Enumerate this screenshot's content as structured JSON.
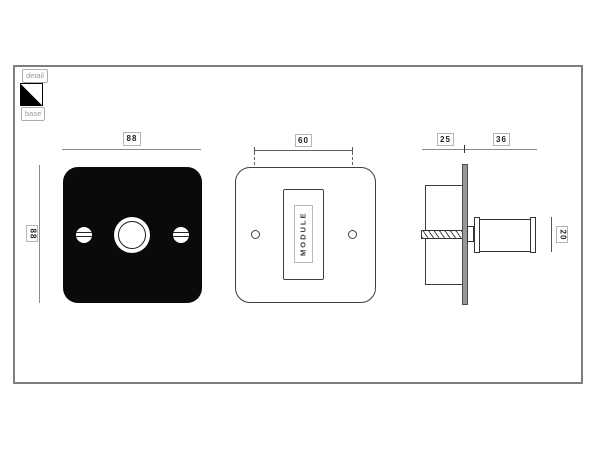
{
  "legend": {
    "detail_label": "detail",
    "base_label": "base",
    "icon": "half-filled-square-swatch-icon"
  },
  "views": {
    "base_front": {
      "width_dim": "88",
      "height_dim": "88"
    },
    "detail_front": {
      "hole_spacing_dim": "60",
      "module_label": "MODULE"
    },
    "side": {
      "recess_depth_dim": "25",
      "projection_dim": "36",
      "knob_diameter_dim": "20"
    }
  },
  "colors": {
    "plate_fill": "#0a0a0a",
    "part_outline": "#3f3f3f",
    "dimension_line": "#8a8a8a",
    "label_border": "#b5b5b5",
    "label_text": "#222222",
    "legend_text": "#9a9a9a",
    "wall_plate_fill": "#989898",
    "frame_border": "#7e7e7e"
  }
}
